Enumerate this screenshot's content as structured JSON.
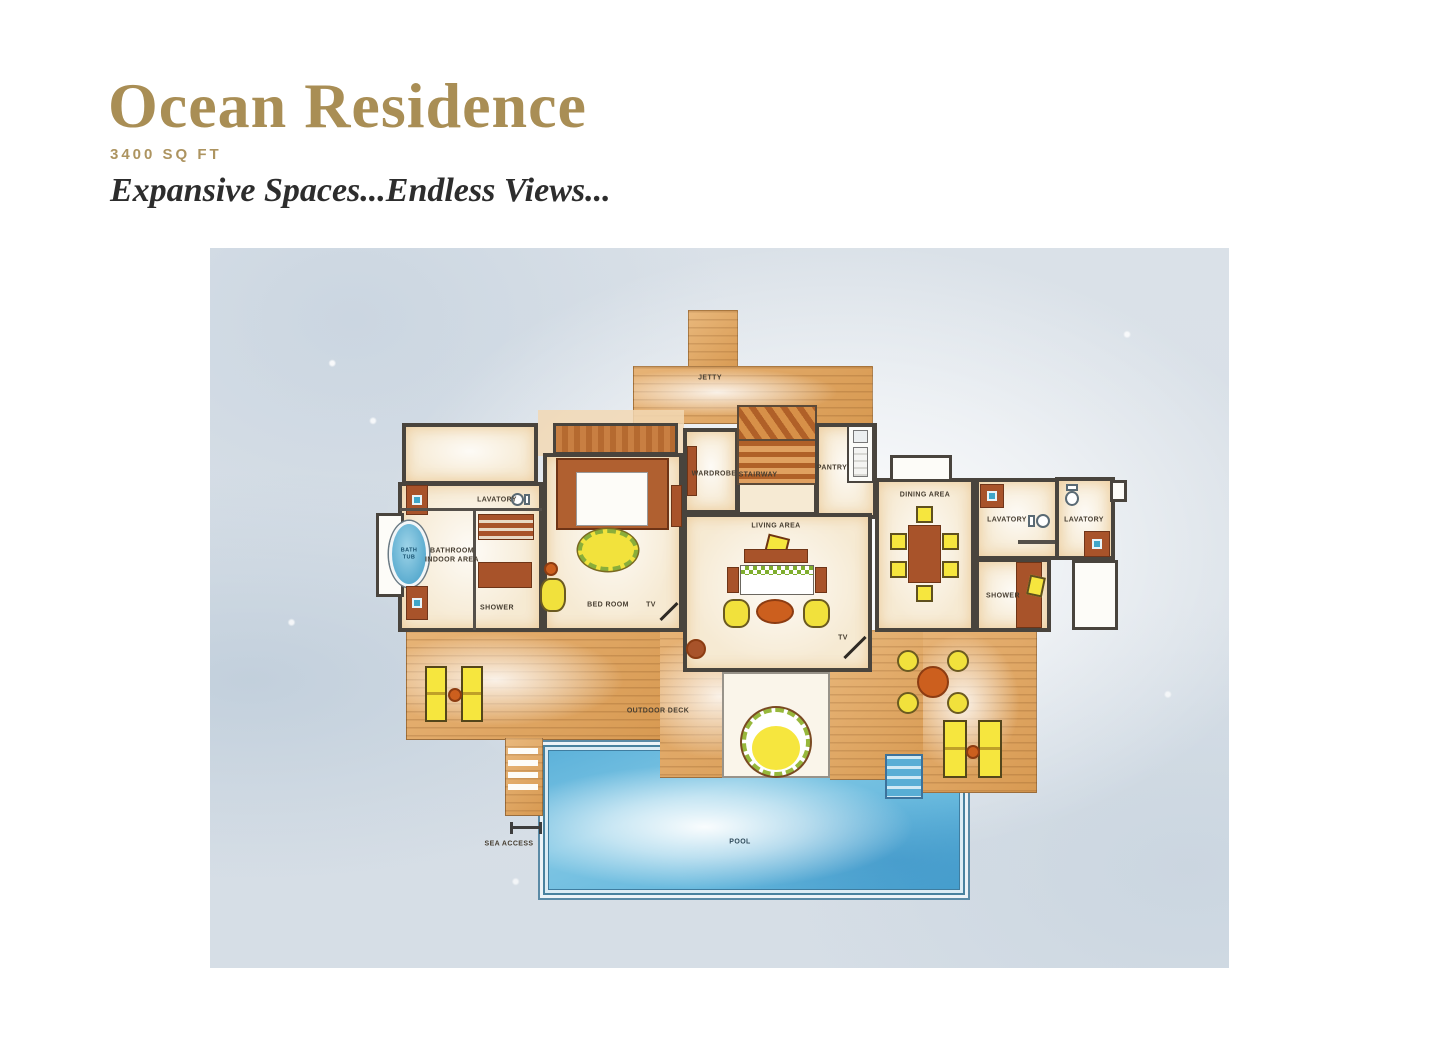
{
  "header": {
    "title": "Ocean Residence",
    "area": "3400 SQ FT",
    "tagline": "Expansive Spaces...Endless Views..."
  },
  "plan": {
    "labels": {
      "jetty": "JETTY",
      "wardrobe": "WARDROBE",
      "stairway": "STAIRWAY",
      "pantry": "PANTRY",
      "living_area": "LIVING AREA",
      "dining_area": "DINING AREA",
      "lavatory_left": "LAVATORY",
      "lavatory_mid": "LAVATORY",
      "lavatory_right": "LAVATORY",
      "bathroom_indoor_area": "BATHROOM\nINDOOR AREA",
      "bath_tub": "BATH\nTUB",
      "shower_left": "SHOWER",
      "shower_right": "SHOWER",
      "bed_room": "BED ROOM",
      "tv_bedroom": "TV",
      "tv_living": "TV",
      "outdoor_deck": "OUTDOOR DECK",
      "sea_access": "SEA ACCESS",
      "pool": "POOL"
    },
    "colors": {
      "accent_gold": "#a98e55",
      "wood": "#dca467",
      "water": "#5fb6da",
      "wall": "#49443d",
      "floor_cream": "#f6ead3",
      "furniture_sienna": "#a8532a",
      "highlight_yellow": "#f1e13c",
      "background": "#dae1e8"
    }
  }
}
